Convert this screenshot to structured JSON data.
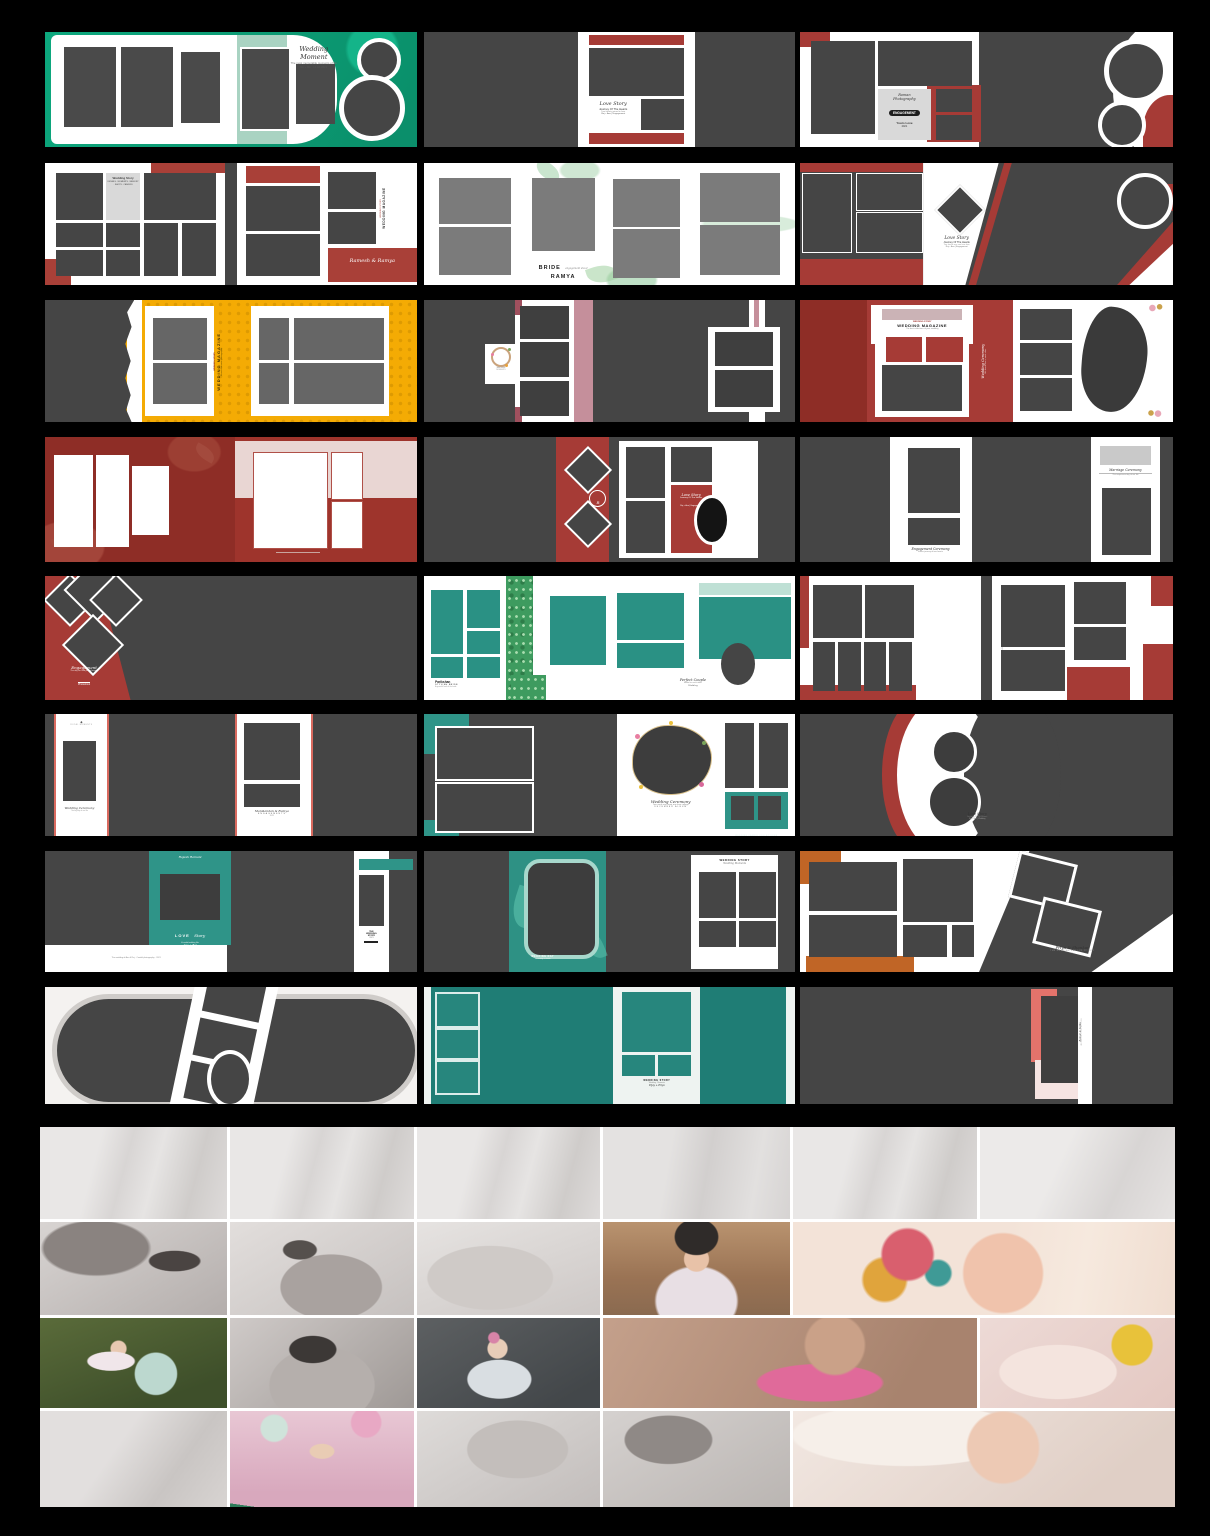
{
  "canvas": {
    "background": "#000000",
    "width": 1210,
    "height": 1536
  },
  "palette": {
    "black": "#000000",
    "charcoal": "#474747",
    "white": "#ffffff",
    "green": "#0b9e77",
    "mint": "#a9d3c2",
    "red": "#a63b36",
    "dark_red": "#8e2d26",
    "yellow": "#f4ab04",
    "rose": "#c58f9b",
    "teal": "#2a9184",
    "teal_dark": "#1f7d75",
    "orange": "#c06526",
    "salmon": "#e4736b",
    "pale_pink": "#f6e4e2",
    "gray_panel": "#d9d9d9"
  },
  "templates": [
    {
      "id": "wedding-moment-green",
      "texts": {
        "title": "Wedding Moment",
        "sub": "The most memorable moments of life",
        "line": "Ro + Ra · 12.04.2021"
      }
    },
    {
      "id": "love-story-charcoal",
      "texts": {
        "script": "Love Story",
        "sub": "Journey Of The Hearts",
        "tiny": "Two hearts joined in love",
        "line": "Raj + Anu | Engagement"
      }
    },
    {
      "id": "engagement-cover",
      "texts": {
        "studio": "Roman",
        "studio2": "Photography",
        "badge": "ENGAGEMENT",
        "couple": "Yours Love",
        "year": "2021"
      }
    },
    {
      "id": "wedding-magazine-red",
      "texts": {
        "panel_title": "Wedding Story",
        "panel_lines": "DETAILS · MOMENTS · MEMORY · SHOTS · CANDIDS",
        "vertical_top": "WEDDING STORY",
        "vertical": "WEDDING MAGAZINE",
        "names": "Ramesh & Ramya"
      }
    },
    {
      "id": "bride-ramya",
      "texts": {
        "bride": "BRIDE",
        "tag": "engagement shoot",
        "name": "RAMYA"
      }
    },
    {
      "id": "love-story-diagonal",
      "texts": {
        "script": "Love Story",
        "sub": "Journey Of The Hearts",
        "tiny": "Two hearts one soul one love",
        "line": "Raj + Anu | Engagement"
      }
    },
    {
      "id": "wedding-magazine-yellow",
      "texts": {
        "vertical_top": "WEDDING STORY",
        "vertical": "WEDDING MAGAZINE",
        "vertical_sub": "A real moments photography"
      }
    },
    {
      "id": "rose-column",
      "texts": {
        "wreath1": "WEDDING",
        "wreath2": "MOMENTS"
      }
    },
    {
      "id": "wedding-magazine-maroon",
      "texts": {
        "mag_top": "WEDDING STORY",
        "mag_title": "WEDDING MAGAZINE",
        "mag_sub": "The best collections of your wedding",
        "ceremony": "Wedding Ceremony",
        "ceremony_sub": "We found love in each other"
      }
    },
    {
      "id": "red-floral-frames",
      "texts": {}
    },
    {
      "id": "diamond-love-story",
      "texts": {
        "mono": "R",
        "script": "Love Story",
        "sub": "Journey Of The Hearts",
        "line": "Raj + Anu | Engagement"
      }
    },
    {
      "id": "twin-strips",
      "texts": {
        "left_script": "Engagement Ceremony",
        "left_sub": "A new journey of two hearts",
        "right_script": "Marriage Ceremony",
        "right_sub": "The auspicious day of our life"
      }
    },
    {
      "id": "engagement-triangles",
      "texts": {
        "script": "Engagement",
        "sub": "The day we said yes to forever",
        "foot": "Photoshoot"
      }
    },
    {
      "id": "teal-pattern",
      "texts": {
        "brand": "Parikshan",
        "brand_sub": "STYLISH BRIDE",
        "brand_tiny": "A graceful look of the bride",
        "script": "Perfect Couple",
        "script_sub": "Made for each other",
        "foot": "Wedding"
      }
    },
    {
      "id": "red-grid-spread",
      "texts": {
        "vertical": "WEDDING MOMENTS 2021"
      }
    },
    {
      "id": "white-strips",
      "texts": {
        "strip1_mark": "◆",
        "strip1_head": "ROYAL MOMENTS",
        "strip1_script": "Wedding Ceremony",
        "strip1_sub": "The big day of our life",
        "strip2_script": "Manikandan & Ramya",
        "strip2_caps": "ENGAGEMENTS",
        "strip2_year": "2021"
      }
    },
    {
      "id": "wreath-ceremony",
      "texts": {
        "script": "Wedding Ceremony",
        "sub": "Two souls one heart one love collage",
        "caps": "DECEMBER ALBUM",
        "caption": "WEDDING CANDID COLLECTIONS"
      }
    },
    {
      "id": "curve-love-story",
      "texts": {
        "script": "Love Story",
        "sub": "Journey Of The Hearts",
        "line": "Raj + Anu | Wedding"
      }
    },
    {
      "id": "teal-band-love",
      "texts": {
        "head": "Rajesh Ramani",
        "box_caps": "LOVE",
        "box_script": "Story",
        "box_sub": "A candid wedding film",
        "names": "Anu + Raj",
        "foot": "The wedding of Anu & Raj · Candid photography · 2021",
        "side1": "THE",
        "side2": "WEDDING",
        "side3": "STORY",
        "side4": "2021"
      }
    },
    {
      "id": "teal-frame",
      "texts": {
        "caption_head": "WEDDING DAY",
        "caption_sub": "Ceremony & Dinner",
        "right_head": "WEDDING STORY",
        "right_script": "Wedding Moments"
      }
    },
    {
      "id": "priya-shankar",
      "texts": {
        "names": "Priya & Shankar",
        "sub": "THE WEDDING DAY | 25.12.2021",
        "mark": "❧"
      }
    },
    {
      "id": "pill-collage",
      "texts": {}
    },
    {
      "id": "teal-columns",
      "texts": {
        "caption_head": "WEDDING STORY",
        "caption_sub": "Wedding · Moments",
        "caption_script": "Vijay + Priya"
      }
    },
    {
      "id": "salmon-strip",
      "texts": {
        "vertical": "Raman & Sethu",
        "vertical_sub": "WEDDING COLLECTION"
      }
    }
  ],
  "collage": {
    "label": "Baby photo album collage",
    "photos": {
      "bw": "black and white baby portrait backdrop",
      "toddler_pigtails": "toddler girl with pigtails",
      "headscarf": "baby with colorful head scarf",
      "balloon_girl": "girl with balloon on grass",
      "rock_baby": "baby with pink bow on rocks",
      "pink_baby": "laughing baby in pink",
      "duck_baby": "baby with yellow duck toy",
      "birthday": "first birthday girl with balloons",
      "newborn": "sleeping newborn"
    }
  }
}
